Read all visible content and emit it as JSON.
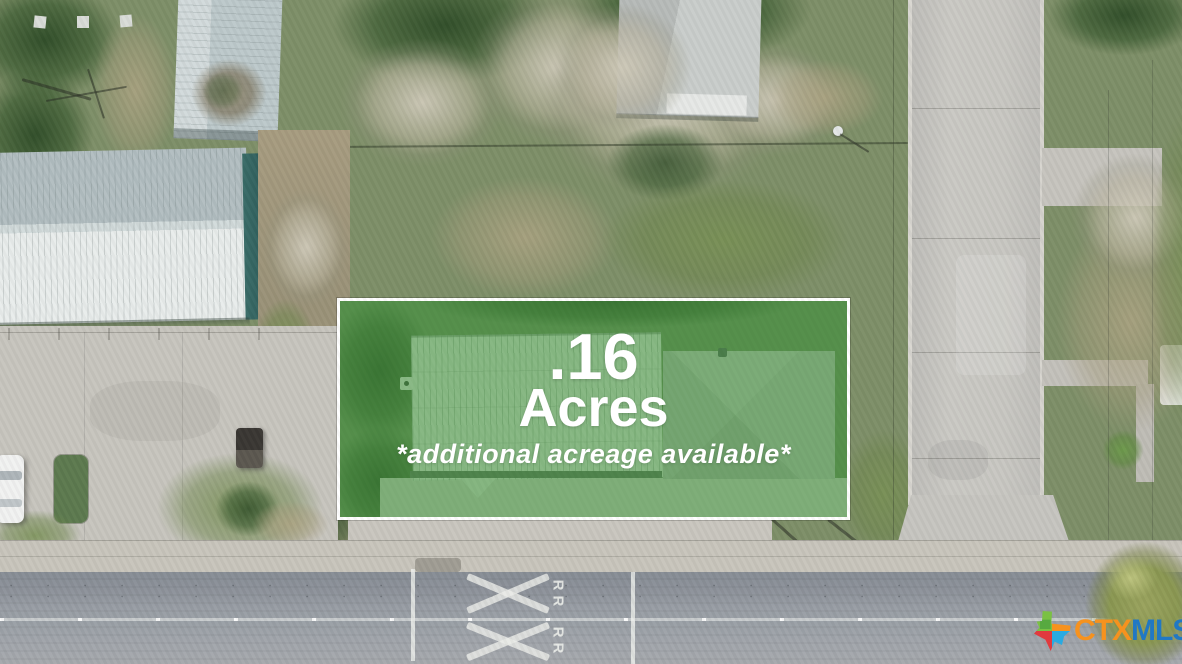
{
  "lot_overlay": {
    "acreage_value": ".16",
    "acreage_unit": "Acres",
    "note": "*additional acreage available*",
    "text_color": "#ffffff",
    "border_color": "#ffffff",
    "fill_color": "rgba(66,148,60,0.55)"
  },
  "road_markings": {
    "rr_label": "RR",
    "paint_color": "#eceeeb"
  },
  "watermark": {
    "ctx": "CTX",
    "mls": "MLS",
    "ctx_color": "#f6921e",
    "mls_color": "#2178c4",
    "texas_icon": "texas-state-icon",
    "texas_icon_colors": [
      "#7ac143",
      "#f6921e",
      "#e03a3e",
      "#29aae1"
    ]
  }
}
